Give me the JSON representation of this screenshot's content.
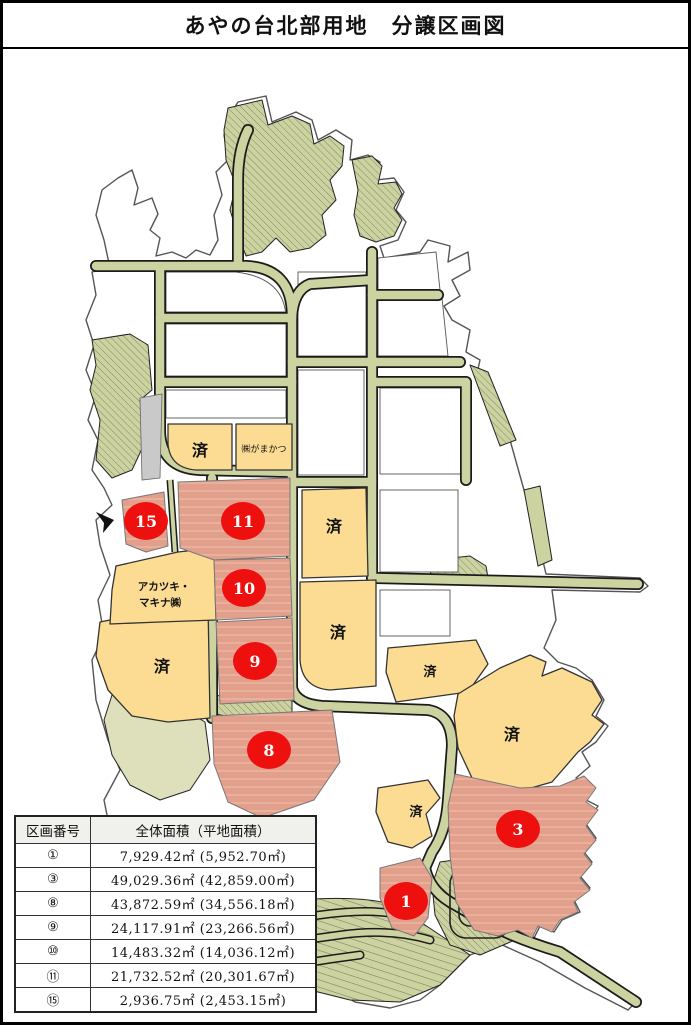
{
  "title": "あやの台北部用地　分譲区画図",
  "map": {
    "sold_label": "済",
    "company_labels": {
      "gamakatsu": "㈱がまかつ",
      "akatsuki_line1": "アカツキ・",
      "akatsuki_line2": "マキナ㈱"
    },
    "lots": {
      "l15": "15",
      "l11": "11",
      "l10": "10",
      "l9": "9",
      "l8": "8",
      "l3": "3",
      "l1": "1"
    },
    "colors": {
      "available_parcel": "#e2a08c",
      "sold_parcel": "#fbdc92",
      "road": "#ccd3a0",
      "marker": "#ee0f0f"
    }
  },
  "table": {
    "headers": {
      "no": "区画番号",
      "area": "全体面積（平地面積）"
    },
    "rows": [
      {
        "no": "①",
        "area": "7,929.42㎡ (5,952.70㎡)"
      },
      {
        "no": "③",
        "area": "49,029.36㎡ (42,859.00㎡)"
      },
      {
        "no": "⑧",
        "area": "43,872.59㎡ (34,556.18㎡)"
      },
      {
        "no": "⑨",
        "area": "24,117.91㎡ (23,266.56㎡)"
      },
      {
        "no": "⑩",
        "area": "14,483.32㎡ (14,036.12㎡)"
      },
      {
        "no": "⑪",
        "area": "21,732.52㎡ (20,301.67㎡)"
      },
      {
        "no": "⑮",
        "area": "2,936.75㎡ (2,453.15㎡)"
      }
    ]
  }
}
